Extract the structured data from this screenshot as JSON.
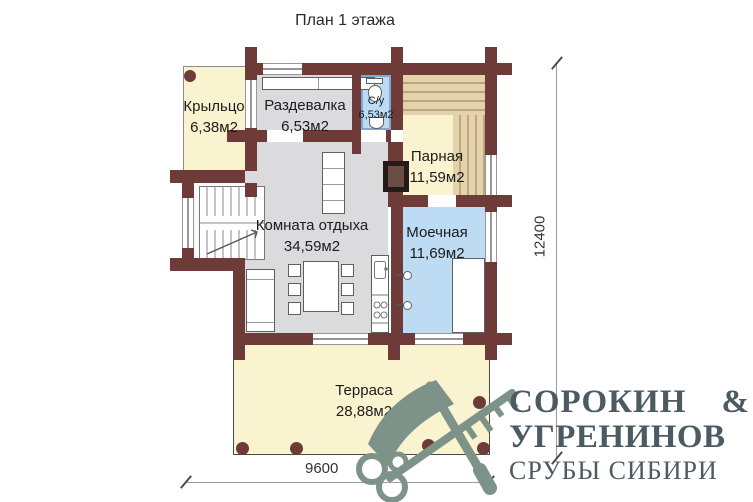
{
  "title": "План 1 этажа",
  "rooms": {
    "porch": {
      "name": "Крыльцо",
      "area": "6,38м2"
    },
    "changing": {
      "name": "Раздевалка",
      "area": "6,53м2"
    },
    "bathroom": {
      "name": "С/у",
      "area": "6,53м2"
    },
    "steam": {
      "name": "Парная",
      "area": "11,59м2"
    },
    "lounge": {
      "name": "Комната отдыха",
      "area": "34,59м2"
    },
    "washing": {
      "name": "Моечная",
      "area": "11,69м2"
    },
    "terrace": {
      "name": "Терраса",
      "area": "28,88м2"
    }
  },
  "dimensions": {
    "vertical": "12400",
    "horizontal": "9600"
  },
  "brand": {
    "line1": "СОРОКИН",
    "amp": "&",
    "line2": "УГРЕНИНОВ",
    "tagline": "СРУБЫ СИБИРИ"
  },
  "colors": {
    "wall": "#6e3b38",
    "room_cream": "#faf3cf",
    "room_gray": "#dbdbdd",
    "room_blue": "#bddbf3",
    "wood_bench": "#e3d2ab",
    "watermark": "#7d938a",
    "brand_text": "#4c5b62"
  },
  "icons": {
    "watermark": "axe-and-key-icon"
  }
}
